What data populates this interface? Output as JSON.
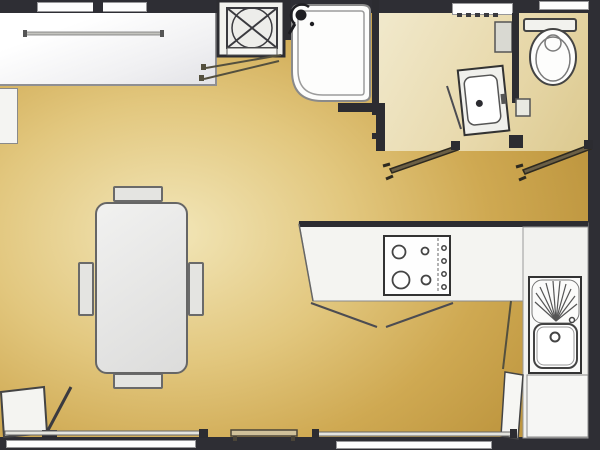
{
  "colors": {
    "wall": "#2e2e34",
    "floor_main_gold": "#d8ba6d",
    "floor_bath_cream": "#e9dcb4",
    "fixture_fill": "#f4f4f1",
    "fixture_outline": "#444444",
    "door_leaf": "#6b5f45",
    "window_fill": "#fdfdfd"
  },
  "rooms": {
    "living": "living-dining-area",
    "kitchen": "kitchen-corner",
    "bathroom": "shower-room",
    "wc": "separate-wc"
  },
  "fixtures": {
    "bed": "bed-platform",
    "shelf": "side-shelf",
    "wardrobe": "wardrobe-heater-cabinet",
    "shower": "corner-shower-cubicle",
    "vanity": "washbasin-vanity-unit",
    "bath_cabinet": "bathroom-wall-cabinet",
    "tp_holder": "wall-box",
    "toilet": "toilet-with-cistern",
    "table": "dining-table",
    "chair_top": "chair",
    "chair_bottom": "chair",
    "chair_left": "chair",
    "chair_right": "chair",
    "counter": "kitchen-worktop",
    "hob": "four-burner-hob",
    "sink": "kitchen-sink-with-drainer",
    "base_unit": "kitchen-base-unit",
    "corner_door": "corner-cabinet-door",
    "entrance": "entrance-door",
    "door_bath": "shower-room-door",
    "door_wc": "wc-door",
    "window_top_left": "window",
    "window_top_bath": "window",
    "window_top_wc": "window",
    "window_bottom_left": "window",
    "window_bottom_right": "window",
    "threshold": "threshold-bench",
    "sill_top": "window-sill",
    "sill_bottom_left": "window-sill",
    "sill_bottom_right": "window-sill"
  }
}
